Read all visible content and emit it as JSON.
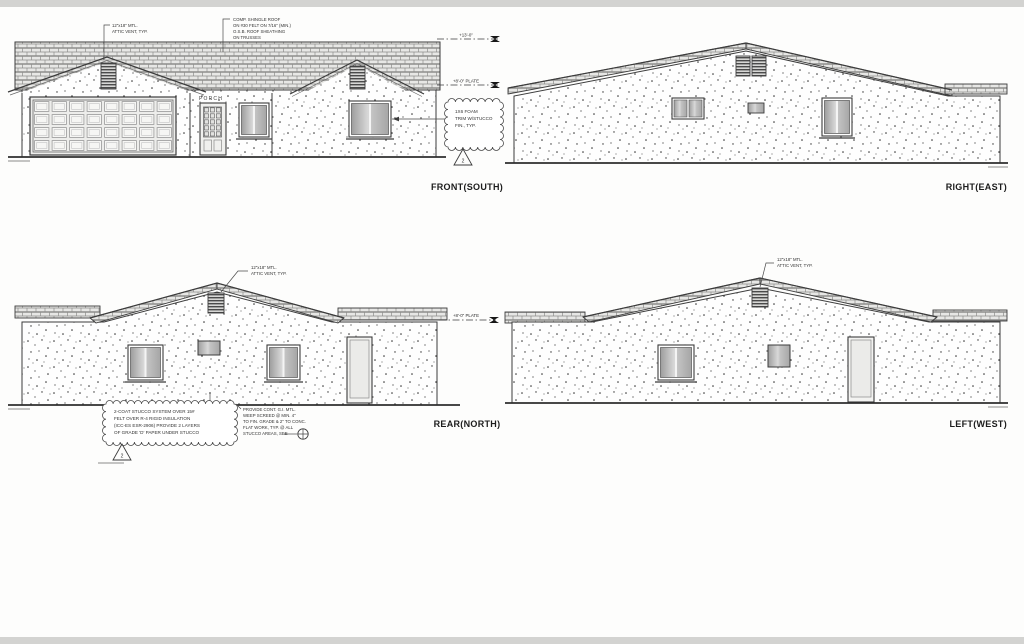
{
  "sheet": {
    "labels": {
      "front": "FRONT(SOUTH)",
      "right": "RIGHT(EAST)",
      "rear": "REAR(NORTH)",
      "left": "LEFT(WEST)"
    },
    "porch": "PORCH",
    "heights": {
      "ridge": "+13'-0\"",
      "plate": "+8'-0\" PLATE"
    },
    "revision": "2",
    "notes": {
      "roof": [
        "COMP. SHINGLE ROOF",
        "ON #30 FELT ON 7/16\" (MIN.)",
        "O.S.B. ROOF SHEATHING",
        "ON TRUSSES"
      ],
      "attic_vent": [
        "12\"x18\" MTL.",
        "ATTIC VENT, TYP."
      ],
      "foam_trim": [
        "1X6 FOAM",
        "TRIM W/STUCCO",
        "FIN., TYP."
      ],
      "stucco": [
        "2-COAT STUCCO SYSTEM OVER 15#",
        "FELT OVER R-4 RIGID INSULATION",
        "(ICC-ES ESR-2906) PROVIDE 2 LAYERS",
        "OF GRADE 'D' PAPER UNDER STUCCO"
      ],
      "weep": [
        "PROVIDE CONT. G.I. MTL.",
        "WEEP SCREED @ MIN. 4\"",
        "TO FIN. GRADE & 2\" TO CONC.",
        "FLAT WORK, TYP. @ ALL",
        "STUCCO AREAS, SEE"
      ]
    },
    "colors": {
      "linework": "#3c3c3c",
      "paper": "#fdfdfc",
      "shingle": "#e8e8e6",
      "glass_dark": "#a6a6a6"
    }
  }
}
